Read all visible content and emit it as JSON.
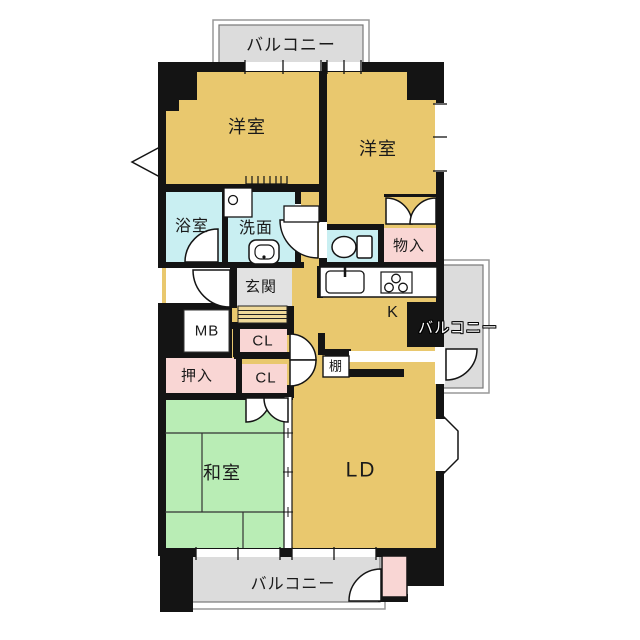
{
  "plan": {
    "kind": "apartment-floor-plan",
    "labels": {
      "balcony_top": "バルコニー",
      "western_room_left": "洋室",
      "western_room_right": "洋室",
      "bath": "浴室",
      "washroom": "洗面",
      "storage": "物入",
      "entrance": "玄関",
      "kitchen": "K",
      "balcony_right": "バルコニー",
      "meter_box": "MB",
      "closet_upper": "CL",
      "closet_lower": "CL",
      "futon_closet": "押入",
      "shelf": "棚",
      "tatami_room": "和室",
      "living_dining": "LD",
      "balcony_bottom": "バルコニー"
    },
    "icons": {
      "toilet": "toilet-icon",
      "kitchen_sink": "kitchen-sink-icon",
      "stove": "stove-icon",
      "wash_basin": "wash-basin-icon",
      "washer_pan": "washer-pan-icon",
      "door_swings": "door-swing-arc"
    },
    "colors": {
      "floor_tan": "#e9c86e",
      "tatami_green": "#b9edb5",
      "water_cyan": "#c9eff2",
      "closet_pink": "#f9d6d4",
      "balcony_gray": "#dcdcdc",
      "entrance_gray": "#e2e2e2",
      "step_tan": "#f0da9a",
      "wall_black": "#141414"
    }
  }
}
